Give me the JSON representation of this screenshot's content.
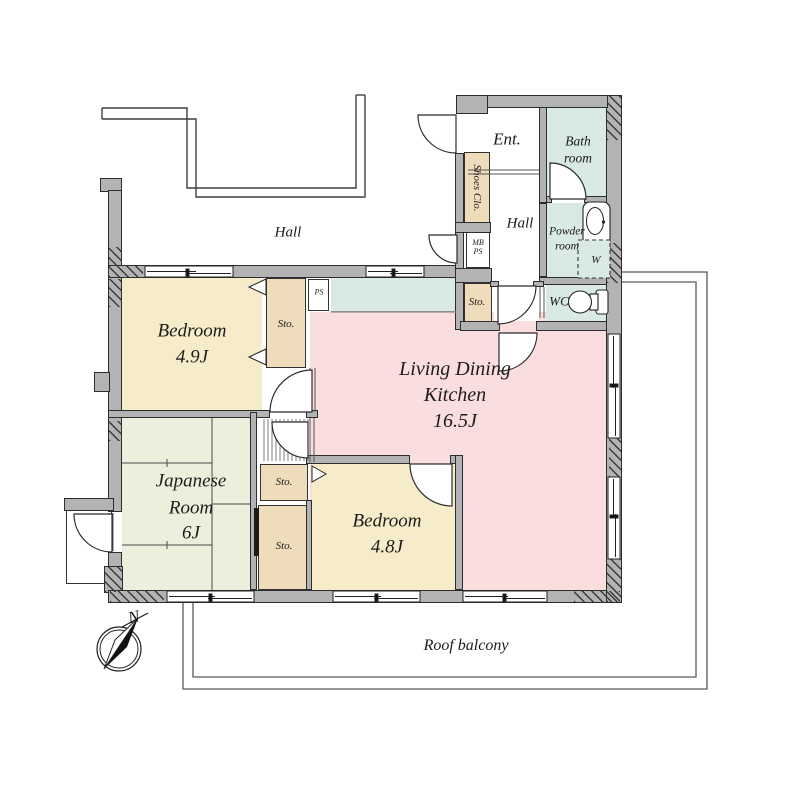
{
  "rooms": {
    "bedroom1": {
      "name": "Bedroom",
      "size": "4.9J"
    },
    "bedroom2": {
      "name": "Bedroom",
      "size": "4.8J"
    },
    "japanese_room": {
      "line1": "Japanese",
      "line2": "Room",
      "size": "6J"
    },
    "ldk": {
      "line1": "Living Dining",
      "line2": "Kitchen",
      "size": "16.5J"
    },
    "entrance": "Ent.",
    "bathroom": {
      "line1": "Bath",
      "line2": "room"
    },
    "powder_room": {
      "line1": "Powder",
      "line2": "room"
    },
    "wc": "WC",
    "inner_hall": "Hall",
    "outer_hall": "Hall",
    "roof_balcony": "Roof balcony"
  },
  "labels": {
    "storage": "Sto.",
    "shoes_closet": "Shoes Clo.",
    "meter_box": "MB",
    "pipe_space": "PS",
    "washing_machine": "W",
    "compass_north": "N"
  },
  "colors": {
    "wall": "#b3b3b3",
    "bedroom_fill": "#f6ecca",
    "ldk_fill": "#fadddd",
    "japanese_fill": "#eaf0dc",
    "wet_area_fill": "#d9e9e5",
    "storage_fill": "#eedcbb",
    "balcony_line": "#5a5a5a"
  }
}
